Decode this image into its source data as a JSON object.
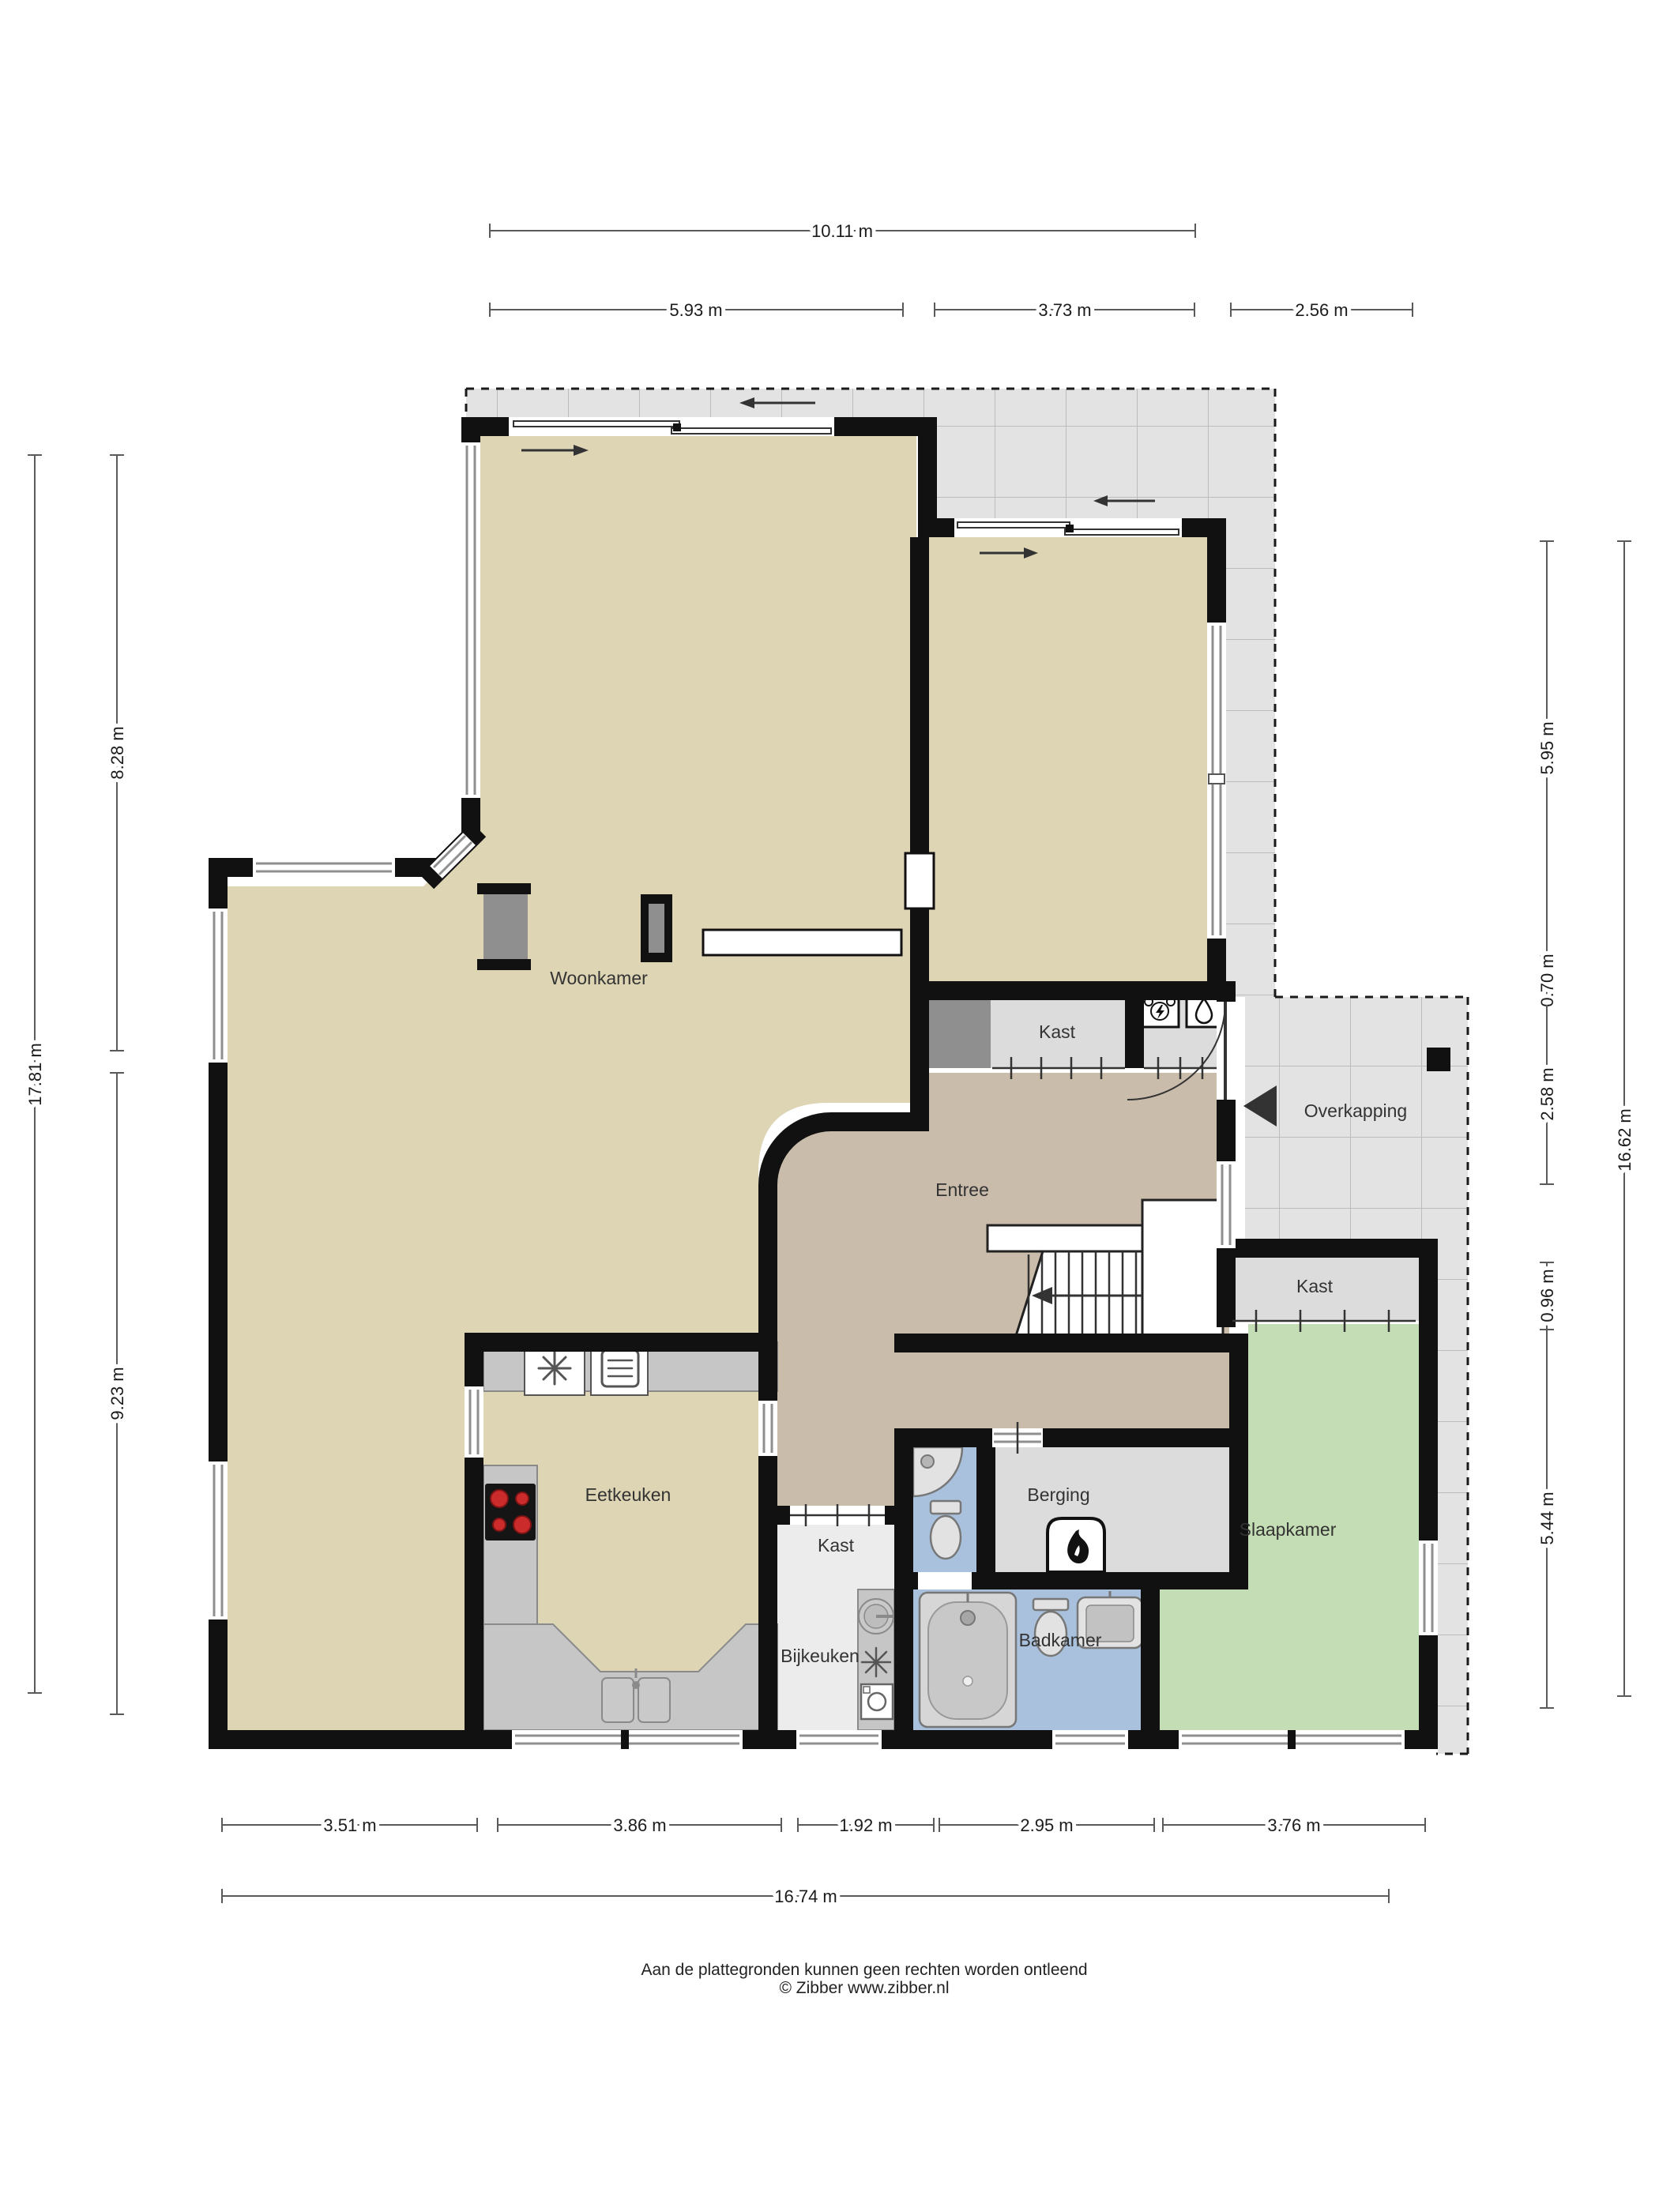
{
  "rooms": [
    {
      "id": "woonkamer",
      "label": "Woonkamer"
    },
    {
      "id": "entree",
      "label": "Entree"
    },
    {
      "id": "eetkeuken",
      "label": "Eetkeuken"
    },
    {
      "id": "slaapkamer",
      "label": "Slaapkamer"
    },
    {
      "id": "badkamer",
      "label": "Badkamer"
    },
    {
      "id": "bijkeuken",
      "label": "Bijkeuken"
    },
    {
      "id": "berging",
      "label": "Berging"
    },
    {
      "id": "overkapping",
      "label": "Overkapping"
    },
    {
      "id": "kast-entree",
      "label": "Kast"
    },
    {
      "id": "kast-slaapkamer",
      "label": "Kast"
    },
    {
      "id": "kast-gang",
      "label": "Kast"
    }
  ],
  "dimensions": {
    "top": [
      {
        "label": "10.11 m"
      },
      {
        "label": "5.93 m"
      },
      {
        "label": "3.73 m"
      },
      {
        "label": "2.56 m"
      }
    ],
    "left": [
      {
        "label": "17.81 m"
      },
      {
        "label": "8.28 m"
      },
      {
        "label": "9.23 m"
      }
    ],
    "right": [
      {
        "label": "5.95 m"
      },
      {
        "label": "0.70 m"
      },
      {
        "label": "2.58 m"
      },
      {
        "label": "0.96 m"
      },
      {
        "label": "5.44 m"
      },
      {
        "label": "16.62 m"
      }
    ],
    "bottom": [
      {
        "label": "3.51 m"
      },
      {
        "label": "3.86 m"
      },
      {
        "label": "1.92 m"
      },
      {
        "label": "2.95 m"
      },
      {
        "label": "3.76 m"
      },
      {
        "label": "16.74 m"
      }
    ]
  },
  "footer": {
    "line1": "Aan de plattegronden kunnen geen rechten worden ontleend",
    "line2": "© Zibber www.zibber.nl"
  },
  "colors": {
    "living": "#ded5b4",
    "hall": "#c9bcab",
    "bedroom": "#c5ddb4",
    "bathroom": "#a9c1dc",
    "closet": "#dcdcdc",
    "utility": "#ececec",
    "terrace_tile": "#e3e3e3",
    "wall": "#111111",
    "counter": "#c6c6c6",
    "cooktop_burner": "#cc2b2b"
  },
  "icons": [
    "extractor-hood-icon",
    "oven-icon",
    "cooktop-icon",
    "kitchen-sink-icon",
    "round-sink-icon",
    "ventilation-icon",
    "washing-machine-icon",
    "shower-icon",
    "toilet-icon",
    "washbasin-icon",
    "bathtub-icon",
    "boiler-flame-icon",
    "electrical-unit-icon",
    "water-heater-icon",
    "entrance-arrow-icon",
    "stairs-up-arrow-icon"
  ]
}
